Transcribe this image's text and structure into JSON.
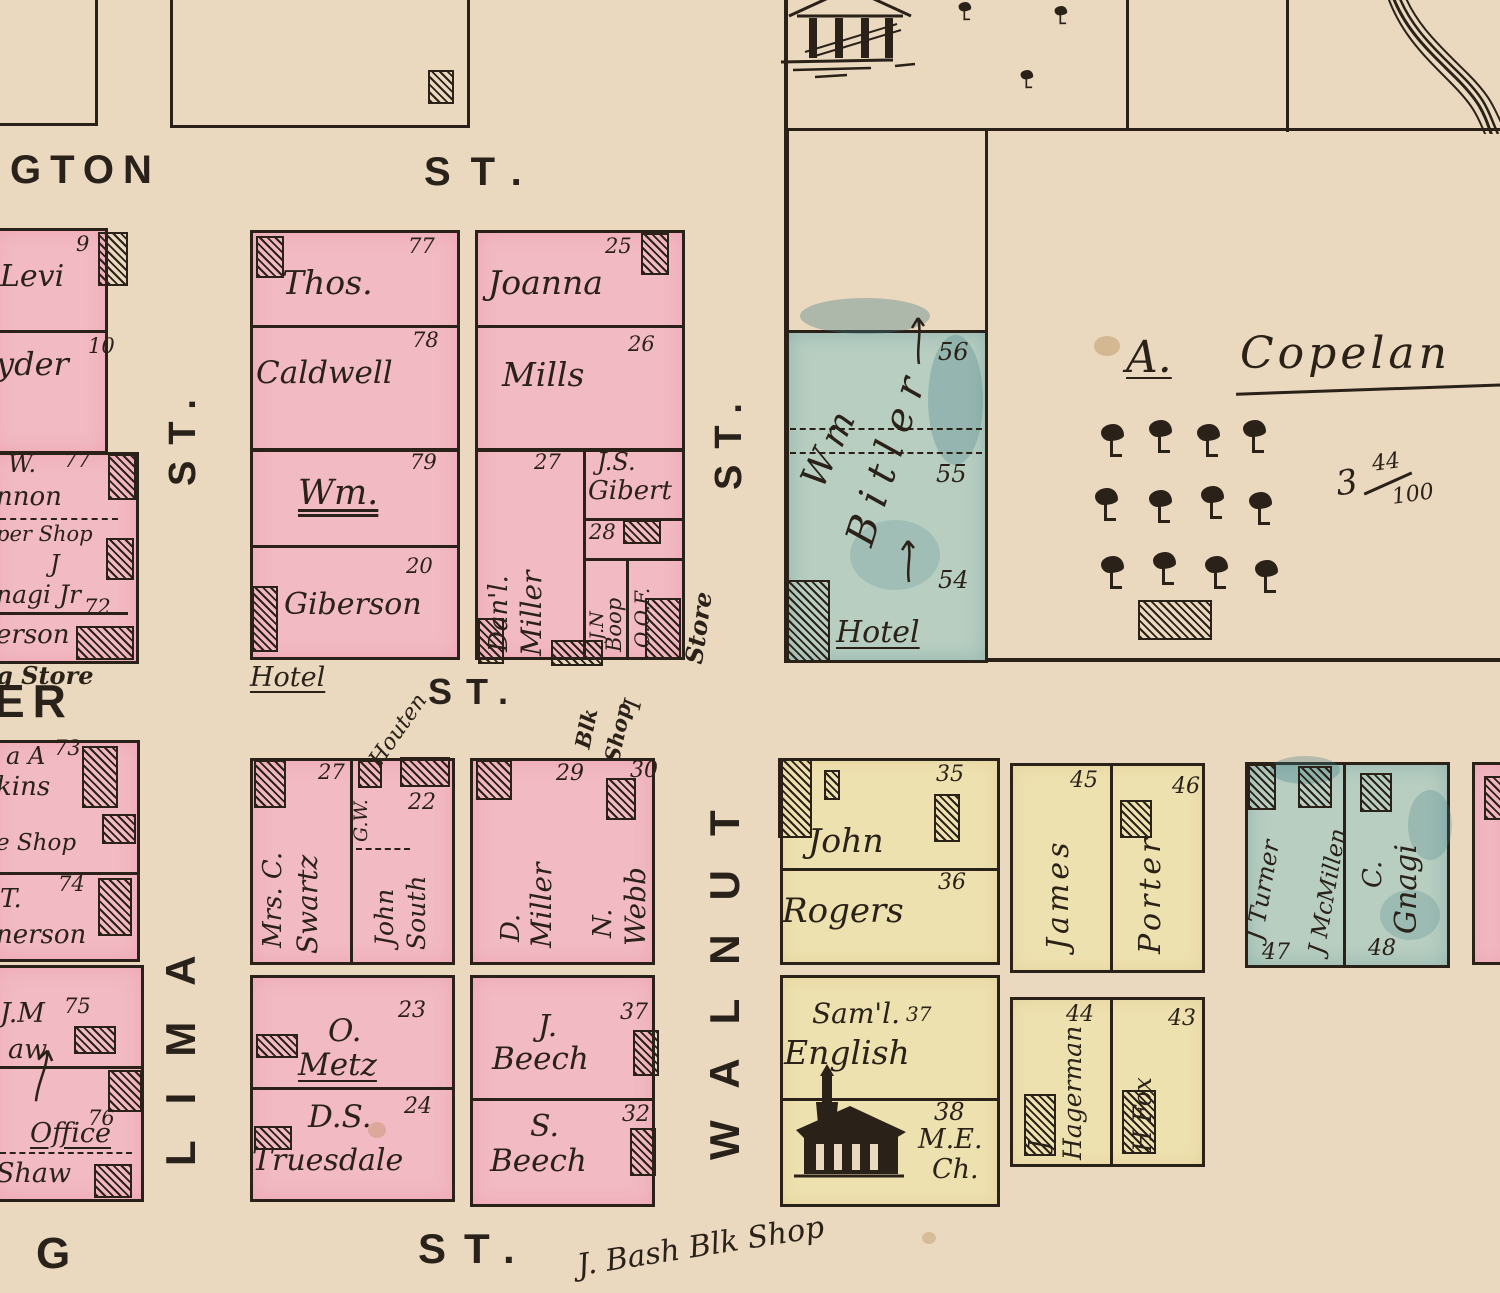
{
  "colors": {
    "paper": "#ead8bf",
    "pink": "#f2bac3",
    "yellow": "#eee1b0",
    "green": "#b8cec1",
    "ink": "#2a2118"
  },
  "streets": {
    "gton": "GTON",
    "st_top": "ST.",
    "er": "ER",
    "st_mid": "ST.",
    "g_bottom": "G",
    "st_bottom": "ST.",
    "lima": "LIMA",
    "lima_st": "ST.",
    "walnut": "WALNUT",
    "walnut_st": "ST."
  },
  "left_col": {
    "lot9": {
      "num": "9",
      "name": "Levi"
    },
    "lot10": {
      "num": "10",
      "name": "yder"
    },
    "block77": {
      "line1": "W.",
      "num": "77",
      "line2": "nnon",
      "line3": "per Shop",
      "line4": "J",
      "line5": "nagi Jr",
      "num2": "72",
      "line6": "erson",
      "below": "g Store"
    },
    "lot73": {
      "pre": "a A",
      "num": "73",
      "line2": "kins",
      "line3": "e Shop"
    },
    "lot74": {
      "num": "74",
      "line1": "T.",
      "line2": "nerson"
    },
    "lot75": {
      "num": "75",
      "line1": "J.M",
      "line2": "aw"
    },
    "lot76": {
      "num": "76",
      "line1": "Office",
      "line2": "Shaw"
    }
  },
  "caldwell_block": {
    "lot77": {
      "num": "77",
      "name": "Thos."
    },
    "lot78": {
      "num": "78",
      "name": "Caldwell"
    },
    "lot79": {
      "num": "79",
      "name": "Wm."
    },
    "lot20": {
      "num": "20",
      "name": "Giberson"
    },
    "hotel": "Hotel"
  },
  "mills_block": {
    "lot25": {
      "num": "25",
      "name": "Joanna"
    },
    "lot26": {
      "num": "26",
      "name": "Mills"
    },
    "lot27": {
      "num": "27",
      "name1": "Dan'l.",
      "name2": "Miller"
    },
    "gibert": {
      "name1": "J.S.",
      "name2": "Gibert",
      "num": "28"
    },
    "boop": {
      "name1": "J.N",
      "name2": "Boop"
    },
    "oof": "O.O.F.",
    "oof_i": "I",
    "store": "Store",
    "blk_shop1": "Blk",
    "blk_shop2": "Shop"
  },
  "bitler": {
    "name1": "Wm",
    "name2": "Bitler",
    "num56": "56",
    "num55": "55",
    "num54": "54",
    "hotel": "Hotel"
  },
  "copeland": {
    "initial": "A.",
    "name": "Copelan",
    "acre_whole": "3",
    "acre_num": "44",
    "acre_den": "100"
  },
  "swartz_block": {
    "num27": "27",
    "name1": "Mrs. C.",
    "name2": "Swartz",
    "strip": {
      "gw": "G.W.",
      "surname": "Houten",
      "num": "22",
      "name1": "John",
      "name2": "South"
    },
    "lot29": {
      "num": "29",
      "name1": "D.",
      "name2": "Miller"
    },
    "lot30": {
      "num": "30",
      "name1": "N.",
      "name2": "Webb"
    }
  },
  "metz_block": {
    "lot23": {
      "num": "23",
      "name1": "O.",
      "name2": "Metz"
    },
    "lot24": {
      "num": "24",
      "name1": "D.S.",
      "name2": "Truesdale"
    }
  },
  "beech_block": {
    "lot37": {
      "num": "37",
      "name1": "J.",
      "name2": "Beech"
    },
    "lot32": {
      "num": "32",
      "name1": "S.",
      "name2": "Beech"
    }
  },
  "rogers_block": {
    "lot35": {
      "num": "35",
      "name": "John"
    },
    "lot36": {
      "num": "36",
      "name": "Rogers"
    }
  },
  "english_block": {
    "lot37": {
      "num": "37",
      "name1": "Sam'l.",
      "name2": "English"
    },
    "lot38": {
      "num": "38",
      "line1": "M.E.",
      "line2": "Ch."
    }
  },
  "porter_block": {
    "lot45": {
      "num": "45",
      "name": "James"
    },
    "lot46": {
      "num": "46",
      "name": "Porter"
    }
  },
  "hagerman_block": {
    "lot44": {
      "num": "44",
      "name1": "J",
      "name2": "Hagerman"
    },
    "lot43": {
      "num": "43",
      "name": "H Fox"
    }
  },
  "gnagi_block": {
    "lot47": {
      "num": "47",
      "name1": "J Turner",
      "name2": "J McMillen"
    },
    "lot48": {
      "num": "48",
      "name1": "C.",
      "name2": "Gnagi"
    }
  },
  "notes": {
    "bash": "J. Bash Blk Shop"
  }
}
